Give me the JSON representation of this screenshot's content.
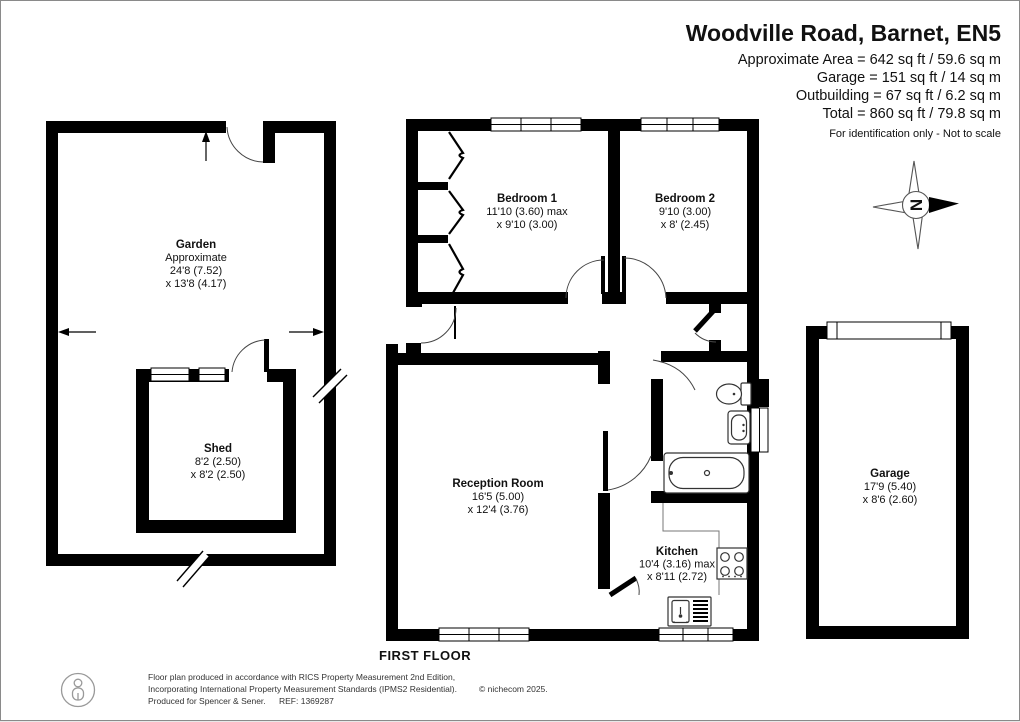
{
  "header": {
    "title": "Woodville Road, Barnet, EN5",
    "area_lines": [
      "Approximate Area = 642 sq ft / 59.6 sq m",
      "Garage = 151 sq ft / 14 sq m",
      "Outbuilding = 67 sq ft / 6.2 sq m",
      "Total = 860 sq ft / 79.8 sq m"
    ],
    "disclaimer": "For identification only - Not to scale"
  },
  "compass": {
    "letter": "N"
  },
  "floor_label": "FIRST FLOOR",
  "rooms": {
    "garden": {
      "name": "Garden",
      "note": "Approximate",
      "dim1": "24'8 (7.52)",
      "dim2": "x 13'8 (4.17)"
    },
    "shed": {
      "name": "Shed",
      "dim1": "8'2 (2.50)",
      "dim2": "x 8'2 (2.50)"
    },
    "bedroom1": {
      "name": "Bedroom 1",
      "dim1": "11'10 (3.60) max",
      "dim2": "x 9'10 (3.00)"
    },
    "bedroom2": {
      "name": "Bedroom 2",
      "dim1": "9'10 (3.00)",
      "dim2": "x 8' (2.45)"
    },
    "reception": {
      "name": "Reception Room",
      "dim1": "16'5 (5.00)",
      "dim2": "x 12'4 (3.76)"
    },
    "kitchen": {
      "name": "Kitchen",
      "dim1": "10'4 (3.16) max",
      "dim2": "x 8'11 (2.72)"
    },
    "garage": {
      "name": "Garage",
      "dim1": "17'9 (5.40)",
      "dim2": "x 8'6 (2.60)"
    }
  },
  "footer": {
    "line1": "Floor plan produced in accordance with RICS Property Measurement 2nd Edition,",
    "line2": "Incorporating International Property Measurement Standards (IPMS2 Residential).",
    "copyright": "© nichecom 2025.",
    "line3": "Produced for Spencer & Sener.",
    "ref": "REF: 1369287"
  },
  "colors": {
    "wall": "#000000",
    "background": "#ffffff",
    "text": "#111111"
  }
}
